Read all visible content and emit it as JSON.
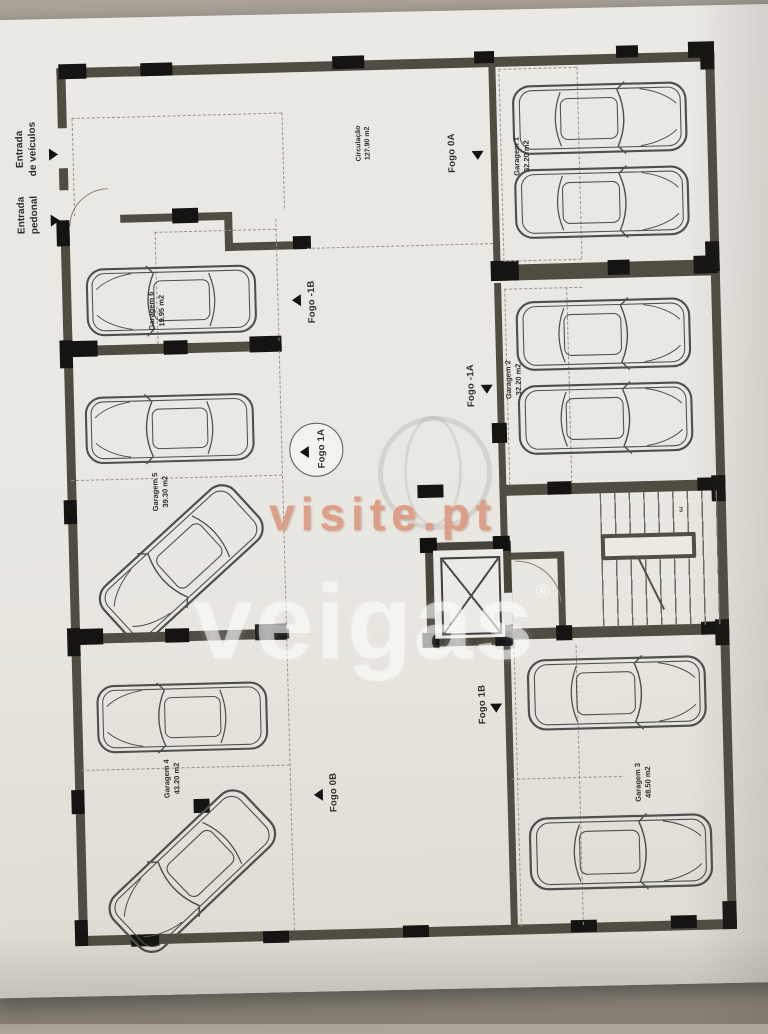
{
  "watermarks": {
    "visite": "visite.pt",
    "veigas": "veigas",
    "registered": "®"
  },
  "entrances": {
    "vehicle_line1": "Entrada",
    "vehicle_line2": "de veículos",
    "pedestrian_line1": "Entrada",
    "pedestrian_line2": "pedonal"
  },
  "circulation": {
    "name": "Circulação",
    "area": "127.90 m2"
  },
  "rooms": [
    {
      "name": "Garagem 1",
      "area": "32.20 m2"
    },
    {
      "name": "Garagem 2",
      "area": "32.20 m2"
    },
    {
      "name": "Garagem 3",
      "area": "48.50 m2"
    },
    {
      "name": "Garagem 4",
      "area": "43.20 m2"
    },
    {
      "name": "Garagem 5",
      "area": "39.30 m2"
    },
    {
      "name": "Garagem 6",
      "area": "19.95 m2"
    }
  ],
  "fogo_labels": [
    {
      "label": "Fogo 0A"
    },
    {
      "label": "Fogo -1B"
    },
    {
      "label": "Fogo -1A"
    },
    {
      "label": "Fogo 1A"
    },
    {
      "label": "Fogo 1B"
    },
    {
      "label": "Fogo 0B"
    }
  ],
  "stairs": {
    "step_number": "3"
  },
  "colors": {
    "wall": "#4f4c42",
    "column": "#151412",
    "paper": "#eae8e2",
    "watermark_visite": "#dd9a82",
    "watermark_veigas": "#fcfcfa"
  }
}
